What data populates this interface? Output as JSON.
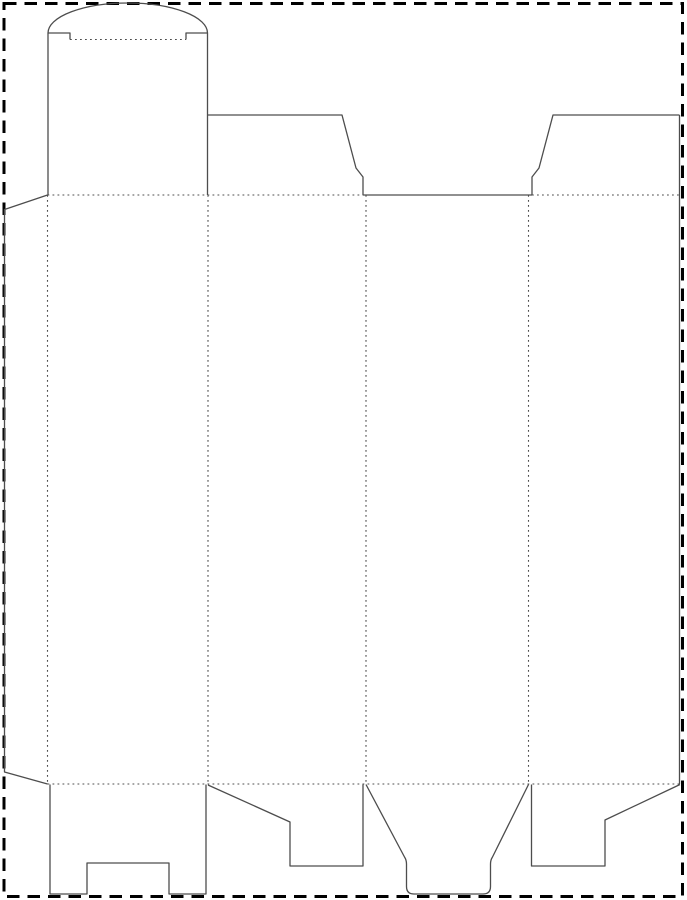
{
  "page": {
    "width": 687,
    "height": 900,
    "background": "#ffffff",
    "border": {
      "name": "page-margin-border",
      "x": 4,
      "y": 3.5,
      "width": 678.5,
      "height": 893,
      "color": "#000000",
      "stroke_width": 3,
      "dash": "12.5 8"
    }
  },
  "dieline": {
    "kind": "reverse-tuck-end-carton-template",
    "colors": {
      "cut": "#4d4d4d",
      "fold": "#4d4d4d"
    },
    "cut_stroke_width": 1.3,
    "fold_stroke_width": 1.1,
    "fold_dash": "1.8 3.2",
    "cut_lines": [
      {
        "name": "tuck-lid-dome-arc",
        "d": "M 48 33 A 79.75 30 0 0 1 207.5 33"
      },
      {
        "name": "tuck-lid-left-edge",
        "d": "M 48 195 L 48 33"
      },
      {
        "name": "tuck-lid-shoulder-left",
        "d": "M 48 33 L 70 33 L 70 39.5"
      },
      {
        "name": "tuck-lid-shoulder-right",
        "d": "M 186 39.5 L 186 33 L 207.5 33"
      },
      {
        "name": "tuck-lid-right-edge",
        "d": "M 207.5 33 L 207.5 195"
      },
      {
        "name": "top-dust-flap-left",
        "d": "M 207.5 115 L 342 115 L 356 168 L 363 177 L 363 195"
      },
      {
        "name": "panel-3-top-cut-edge",
        "d": "M 363 195 L 532 195"
      },
      {
        "name": "top-dust-flap-right",
        "d": "M 532 195 L 532 177 L 539 168 L 553 115 L 679.5 115"
      },
      {
        "name": "body-right-cut-edge",
        "d": "M 679.5 115 L 679.5 784"
      },
      {
        "name": "glue-flap-outline",
        "d": "M 47.5 195 L 4.5 209.5 L 4.5 772 L 47.5 784"
      },
      {
        "name": "bottom-flap-panel-1-notched",
        "d": "M 50 784.5 L 50 894 L 87 894 L 87 863 L 169 863 L 169 894 L 206 894 L 206 784.5"
      },
      {
        "name": "bottom-dust-flap-left",
        "d": "M 208 785 L 290 822 L 290 866 L 363 866 L 363 784.5"
      },
      {
        "name": "bottom-tuck-tongue",
        "d": "M 366 784.5 L 404.5 857 Q 406.5 860 406.5 864 L 406.5 886.5 Q 406.5 894 414 894 L 483 894 Q 490.5 894 490.5 886.5 L 490.5 864 Q 490.5 860 492.5 857 L 528.5 784.5"
      },
      {
        "name": "bottom-dust-flap-right",
        "d": "M 531.5 784.5 L 531.5 866 L 605 866 L 605 820 L 680 784.5"
      }
    ],
    "fold_lines": [
      {
        "name": "tuck-lid-tongue-fold",
        "d": "M 70 39.5 L 186 39.5"
      },
      {
        "name": "top-fold-left-span",
        "d": "M 47.5 195 L 363 195"
      },
      {
        "name": "top-fold-right-span",
        "d": "M 532 195 L 680 195"
      },
      {
        "name": "bottom-fold-span",
        "d": "M 47.5 784 L 680 784"
      },
      {
        "name": "glue-flap-fold",
        "d": "M 47.5 195 L 47.5 784"
      },
      {
        "name": "panel-1-2-fold",
        "d": "M 208 195 L 208 784"
      },
      {
        "name": "panel-2-3-fold",
        "d": "M 366 195 L 366 784"
      },
      {
        "name": "panel-3-4-fold",
        "d": "M 528.5 195 L 528.5 784"
      }
    ]
  }
}
